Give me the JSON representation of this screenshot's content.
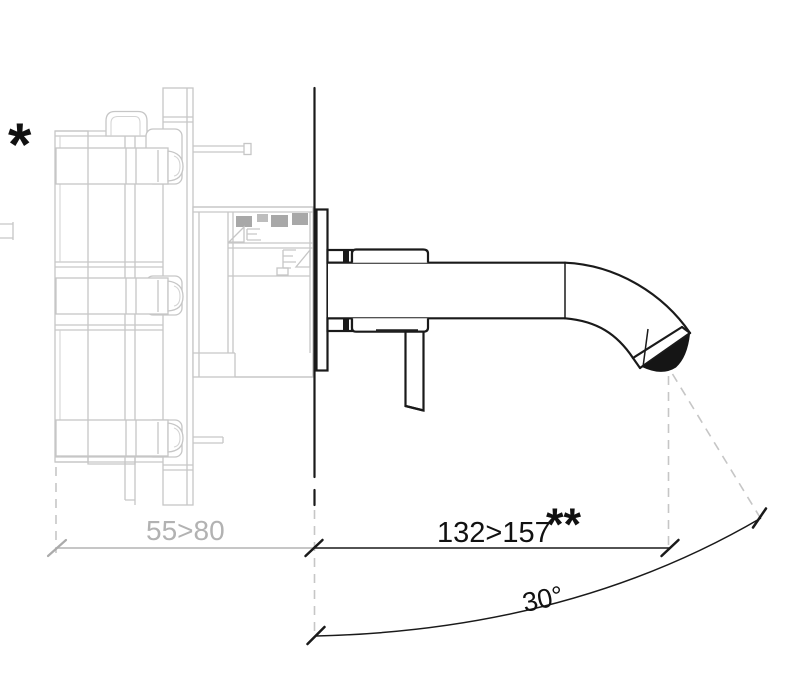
{
  "drawing": {
    "kind": "technical installation drawing",
    "annotations": {
      "asterisk_note": "*",
      "double_asterisk_note": "**",
      "depth_dimension": "55>80",
      "reach_dimension": "132>157",
      "spout_angle": "30°"
    },
    "colors": {
      "foreground_line": "#1a1a1a",
      "inwall_body_line": "#c6c6c6",
      "gray_dimension_text": "#b2b2b2",
      "dashed_projection": "#c6c6c6",
      "background": "#ffffff"
    }
  }
}
